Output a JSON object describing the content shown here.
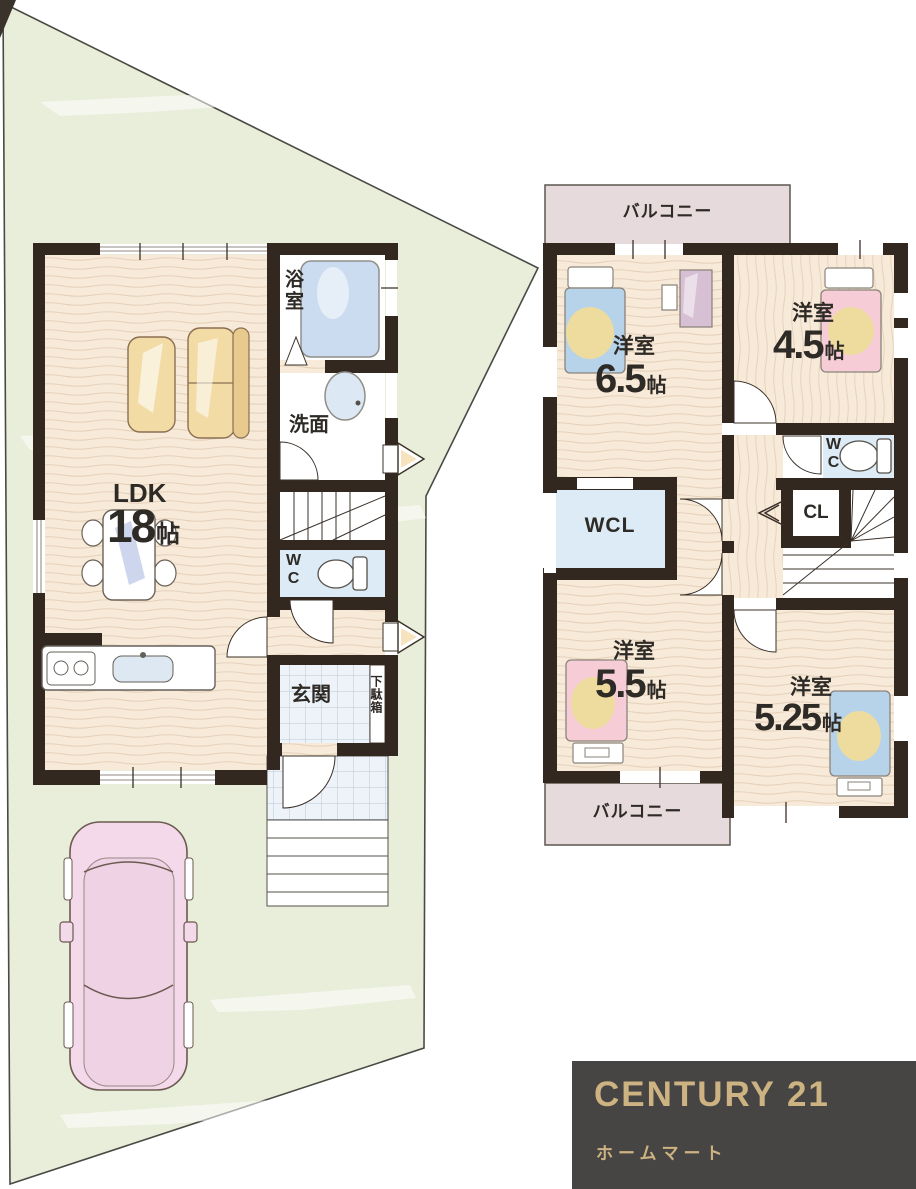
{
  "floor1": {
    "ldk": {
      "name": "LDK",
      "size": "18",
      "unit": "帖"
    },
    "bath": "浴室",
    "washroom": "洗面",
    "wc": "WC",
    "entrance": "玄関",
    "shoe_cabinet": "下駄箱"
  },
  "floor2": {
    "balcony_top": "バルコニー",
    "balcony_bottom": "バルコニー",
    "bedroom_65": {
      "name": "洋室",
      "size": "6.5",
      "unit": "帖"
    },
    "bedroom_45": {
      "name": "洋室",
      "size": "4.5",
      "unit": "帖"
    },
    "bedroom_55": {
      "name": "洋室",
      "size": "5.5",
      "unit": "帖"
    },
    "bedroom_525": {
      "name": "洋室",
      "size": "5.25",
      "unit": "帖"
    },
    "walk_in_closet": "WCL",
    "closet": "CL",
    "wc": "WC"
  },
  "branding": {
    "company": "CENTURY 21",
    "store_name": "ホームマート"
  },
  "colors": {
    "wall": "#32281f",
    "wood_floor": "#f8ead9",
    "tile_floor": "#edf3f8",
    "water_room_blue": "#dcebf5",
    "balcony_pink": "#e7dadd",
    "lot_green": "#e9eedb",
    "logo_background": "#474544",
    "logo_gold": "#cdb382",
    "bed_blue": "#b7d3e9",
    "bed_pink": "#f6cdd6",
    "blanket_yellow": "#eedc9f",
    "sofa_yellow": "#f2dba4",
    "car_pink": "#f3d9e9"
  }
}
